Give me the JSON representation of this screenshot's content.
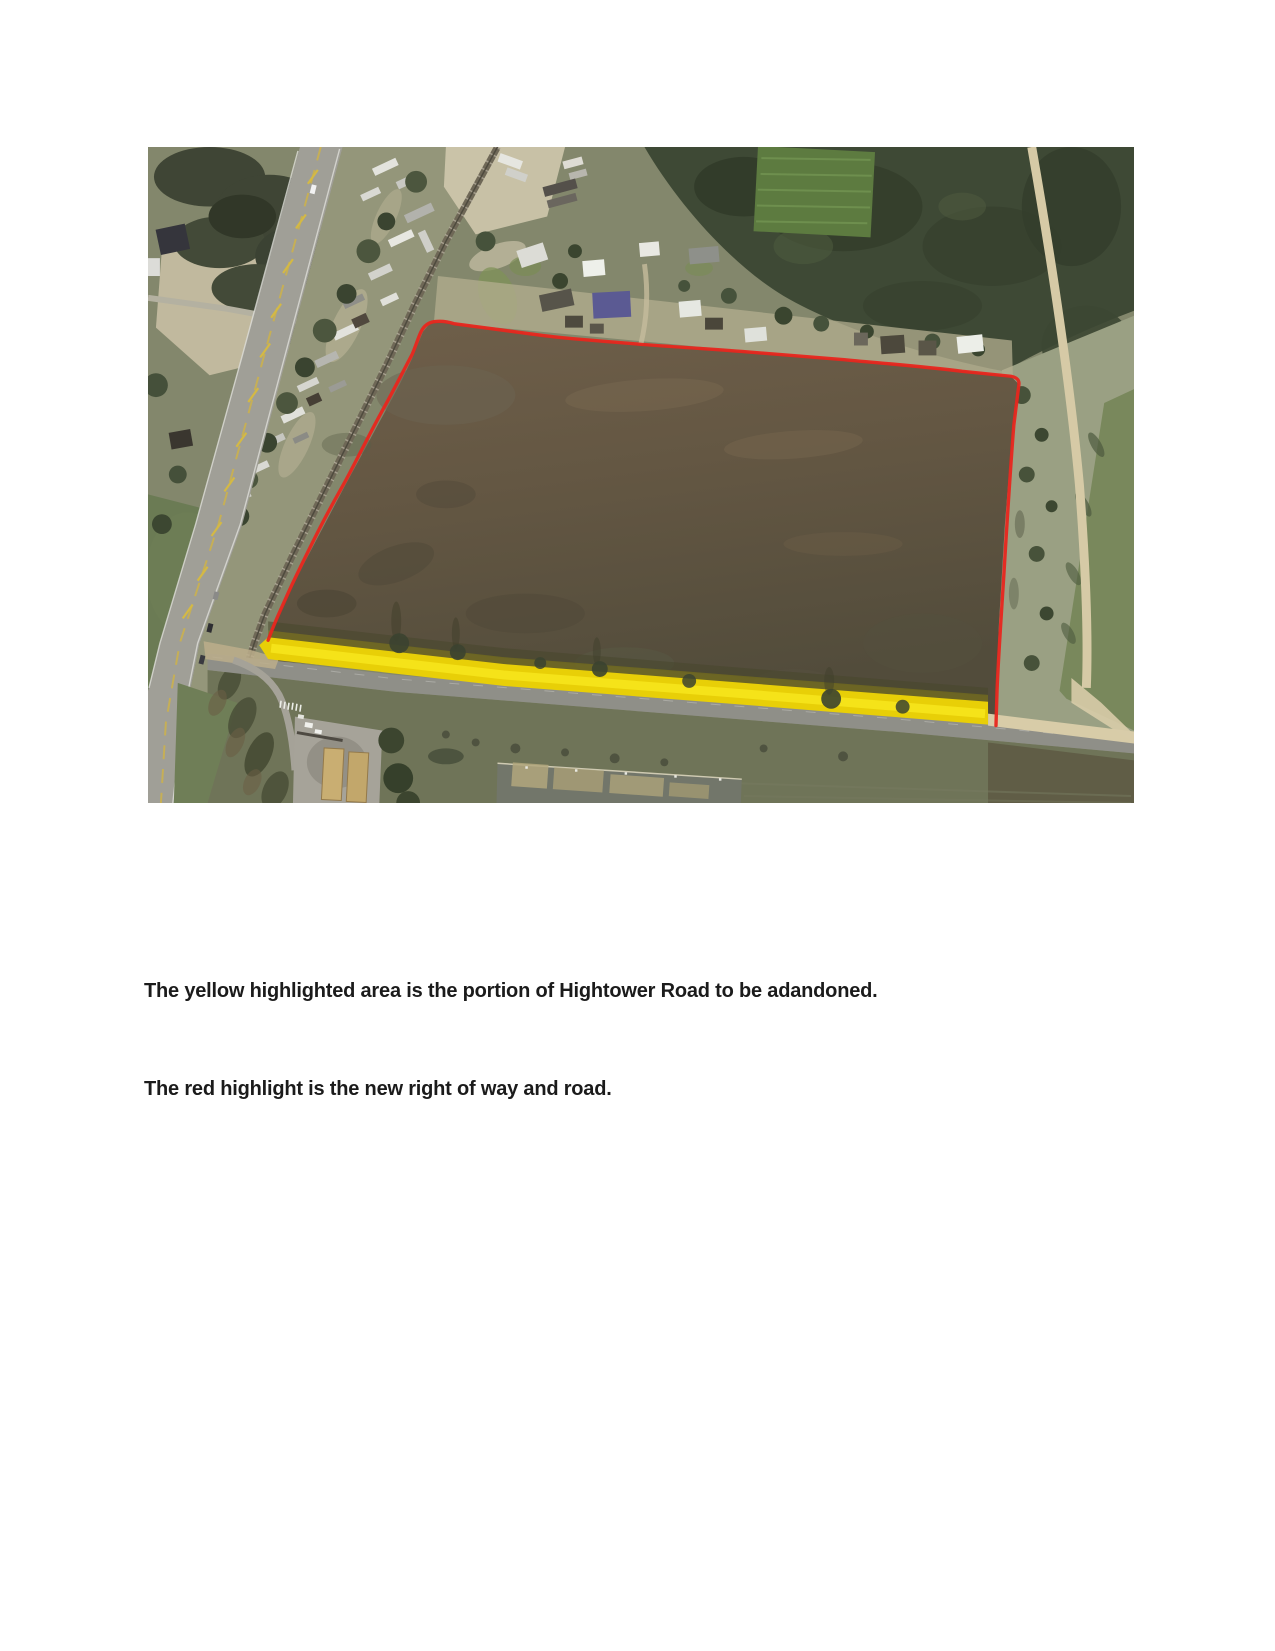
{
  "captions": {
    "yellow_caption": "The yellow highlighted area is the portion of Hightower Road to be adandoned.",
    "red_caption": "The red highlight is the new right of way and road."
  },
  "figure": {
    "yellow_highlight_color": "#ecd50a",
    "red_outline_color": "#e8261d"
  }
}
